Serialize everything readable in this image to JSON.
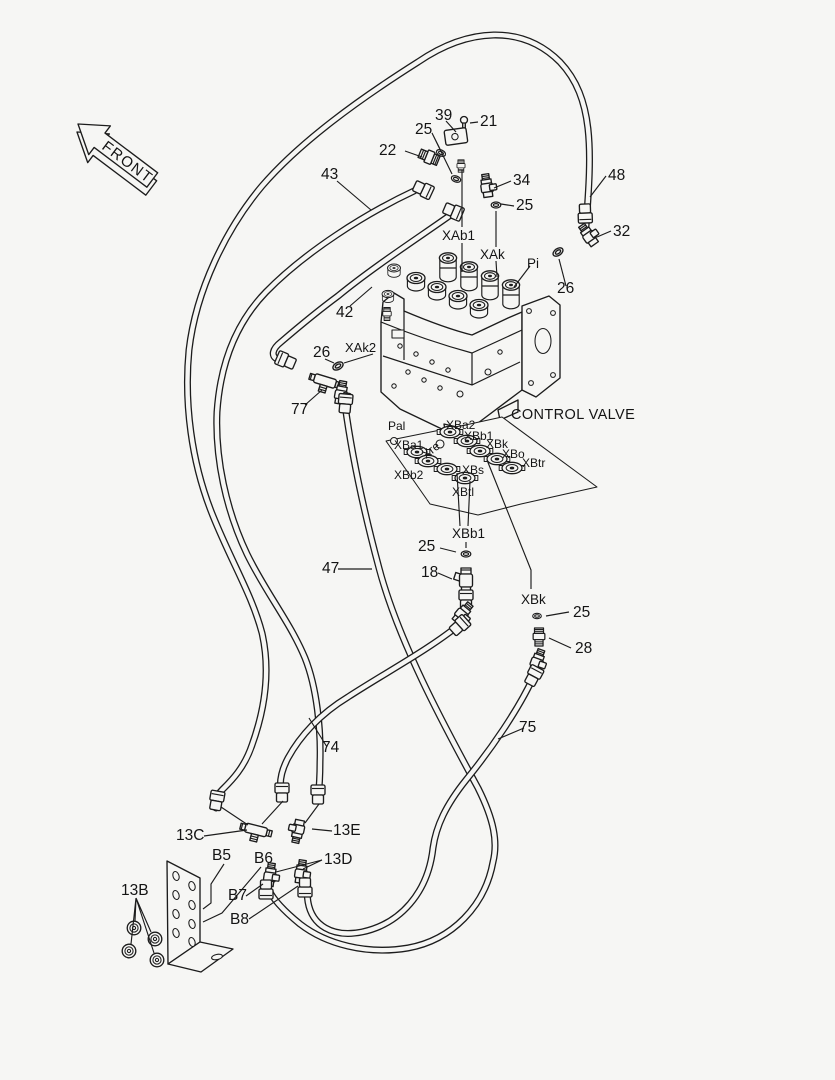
{
  "meta": {
    "description_label": "Hydraulic pilot piping parts diagram",
    "colors": {
      "line": "#1c1c1c",
      "background": "#f6f6f4"
    }
  },
  "diagram": {
    "front_label": "FRONT",
    "valve_label": "CONTROL VALVE",
    "labels": [
      {
        "t": "39",
        "x": 435,
        "y": 120,
        "fs": 15.5
      },
      {
        "t": "21",
        "x": 480,
        "y": 126,
        "fs": 15.5
      },
      {
        "t": "25",
        "x": 415,
        "y": 134,
        "fs": 15.5
      },
      {
        "t": "22",
        "x": 379,
        "y": 155,
        "fs": 15.5
      },
      {
        "t": "43",
        "x": 321,
        "y": 179,
        "fs": 15.5
      },
      {
        "t": "34",
        "x": 513,
        "y": 185,
        "fs": 15.5
      },
      {
        "t": "48",
        "x": 608,
        "y": 180,
        "fs": 15.5
      },
      {
        "t": "25",
        "x": 516,
        "y": 210,
        "fs": 15.5
      },
      {
        "t": "32",
        "x": 613,
        "y": 236,
        "fs": 15.5
      },
      {
        "t": "XAb1",
        "x": 442,
        "y": 240,
        "fs": 13.5
      },
      {
        "t": "XAk",
        "x": 480,
        "y": 259,
        "fs": 13.5
      },
      {
        "t": "Pi",
        "x": 527,
        "y": 268,
        "fs": 13.5
      },
      {
        "t": "26",
        "x": 557,
        "y": 293,
        "fs": 15.5
      },
      {
        "t": "42",
        "x": 336,
        "y": 317,
        "fs": 15.5
      },
      {
        "t": "XAk2",
        "x": 345,
        "y": 352,
        "fs": 13
      },
      {
        "t": "26",
        "x": 313,
        "y": 357,
        "fs": 15.5
      },
      {
        "t": "77",
        "x": 291,
        "y": 414,
        "fs": 15.5
      },
      {
        "t": "CONTROL VALVE",
        "x": 511,
        "y": 419,
        "fs": 14.5,
        "ls": 0.4
      },
      {
        "t": "Pal",
        "x": 388,
        "y": 430,
        "fs": 12
      },
      {
        "t": "XBa2",
        "x": 446,
        "y": 429,
        "fs": 12
      },
      {
        "t": "XBb1",
        "x": 464,
        "y": 440,
        "fs": 12
      },
      {
        "t": "XBa1",
        "x": 394,
        "y": 449,
        "fs": 12
      },
      {
        "t": "Xre",
        "x": 426,
        "y": 459,
        "fs": 12,
        "rot": -38
      },
      {
        "t": "XBk",
        "x": 486,
        "y": 448,
        "fs": 12
      },
      {
        "t": "XBo",
        "x": 502,
        "y": 458,
        "fs": 12
      },
      {
        "t": "XBtr",
        "x": 522,
        "y": 467,
        "fs": 12
      },
      {
        "t": "XBb2",
        "x": 394,
        "y": 479,
        "fs": 12
      },
      {
        "t": "XBs",
        "x": 462,
        "y": 474,
        "fs": 12
      },
      {
        "t": "XBtl",
        "x": 452,
        "y": 496,
        "fs": 12
      },
      {
        "t": "XBb1",
        "x": 452,
        "y": 538,
        "fs": 13.5
      },
      {
        "t": "25",
        "x": 418,
        "y": 551,
        "fs": 15.5
      },
      {
        "t": "47",
        "x": 322,
        "y": 573,
        "fs": 15.5
      },
      {
        "t": "18",
        "x": 421,
        "y": 577,
        "fs": 15.5
      },
      {
        "t": "XBk",
        "x": 521,
        "y": 604,
        "fs": 13.5
      },
      {
        "t": "25",
        "x": 573,
        "y": 617,
        "fs": 15.5
      },
      {
        "t": "28",
        "x": 575,
        "y": 653,
        "fs": 15.5
      },
      {
        "t": "75",
        "x": 519,
        "y": 732,
        "fs": 15.5
      },
      {
        "t": "74",
        "x": 322,
        "y": 752,
        "fs": 15.5
      },
      {
        "t": "13C",
        "x": 176,
        "y": 840,
        "fs": 15.5
      },
      {
        "t": "13E",
        "x": 333,
        "y": 835,
        "fs": 15.5
      },
      {
        "t": "B5",
        "x": 212,
        "y": 860,
        "fs": 15.5
      },
      {
        "t": "B6",
        "x": 254,
        "y": 863,
        "fs": 15.5
      },
      {
        "t": "13D",
        "x": 324,
        "y": 864,
        "fs": 15.5
      },
      {
        "t": "13B",
        "x": 121,
        "y": 895,
        "fs": 15.5
      },
      {
        "t": "B7",
        "x": 228,
        "y": 900,
        "fs": 15.5
      },
      {
        "t": "B8",
        "x": 230,
        "y": 924,
        "fs": 15.5
      }
    ]
  }
}
